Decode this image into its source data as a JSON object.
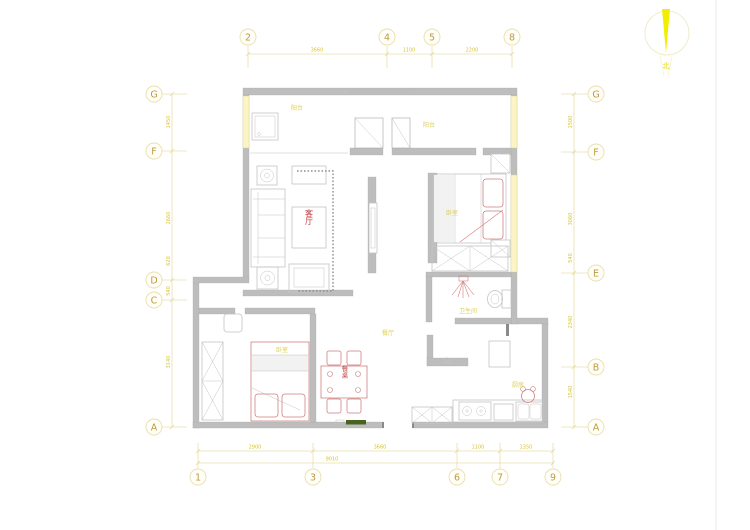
{
  "page": {
    "type": "architectural floor plan drawing",
    "background": "#ffffff"
  },
  "colors": {
    "wall": "#bdbdbd",
    "furniture_line": "#c4c4c4",
    "accent_red": "#cf7f7f",
    "label_red": "#c23b3b",
    "annotation_yellow": "#d8c434",
    "label_yellow": "#dcd054",
    "bubble_gold": "#bf9b3f",
    "north_yellow": "#f2ee00",
    "window_fill": "#faf4c6",
    "threshold_green": "#47631e"
  },
  "north": {
    "label": "北"
  },
  "grid": {
    "top": [
      {
        "label": "2",
        "x": 248
      },
      {
        "label": "4",
        "x": 387
      },
      {
        "label": "5",
        "x": 432
      },
      {
        "label": "8",
        "x": 512
      }
    ],
    "bottom": [
      {
        "label": "1",
        "x": 198
      },
      {
        "label": "3",
        "x": 313
      },
      {
        "label": "6",
        "x": 457
      },
      {
        "label": "7",
        "x": 500
      },
      {
        "label": "9",
        "x": 553
      }
    ],
    "left": [
      {
        "label": "G",
        "y": 94
      },
      {
        "label": "F",
        "y": 151
      },
      {
        "label": "D",
        "y": 280
      },
      {
        "label": "C",
        "y": 300
      },
      {
        "label": "A",
        "y": 427
      }
    ],
    "right": [
      {
        "label": "G",
        "y": 94
      },
      {
        "label": "F",
        "y": 152
      },
      {
        "label": "E",
        "y": 273
      },
      {
        "label": "B",
        "y": 367
      },
      {
        "label": "A",
        "y": 427
      }
    ]
  },
  "dimensions": {
    "top": [
      {
        "text": "3660",
        "x": 317
      },
      {
        "text": "1100",
        "x": 409
      },
      {
        "text": "2200",
        "x": 472
      }
    ],
    "bottom": [
      {
        "text": "2900",
        "x": 255
      },
      {
        "text": "3660",
        "x": 380
      },
      {
        "text": "1100",
        "x": 478
      },
      {
        "text": "1350",
        "x": 526
      }
    ],
    "bottom_overall": {
      "text": "9010",
      "x": 332
    },
    "left": [
      {
        "text": "1450",
        "y": 122
      },
      {
        "text": "2660",
        "y": 218
      },
      {
        "text": "620",
        "y": 261
      },
      {
        "text": "540",
        "y": 291
      },
      {
        "text": "3140",
        "y": 362
      }
    ],
    "right": [
      {
        "text": "1500",
        "y": 122
      },
      {
        "text": "3060",
        "y": 219
      },
      {
        "text": "540",
        "y": 258
      },
      {
        "text": "2340",
        "y": 322
      },
      {
        "text": "1540",
        "y": 392
      }
    ]
  },
  "rooms": {
    "living": {
      "label": "客厅"
    },
    "balcony_left": {
      "label": "阳台"
    },
    "balcony_right": {
      "label": "阳台"
    },
    "bedroom_master": {
      "label": "卧室"
    },
    "bedroom_second": {
      "label": "卧室"
    },
    "bathroom": {
      "label": "卫生间"
    },
    "dining": {
      "label": "餐厅"
    },
    "kitchen": {
      "label": "厨房"
    },
    "dining_table": {
      "label": "餐桌"
    }
  }
}
